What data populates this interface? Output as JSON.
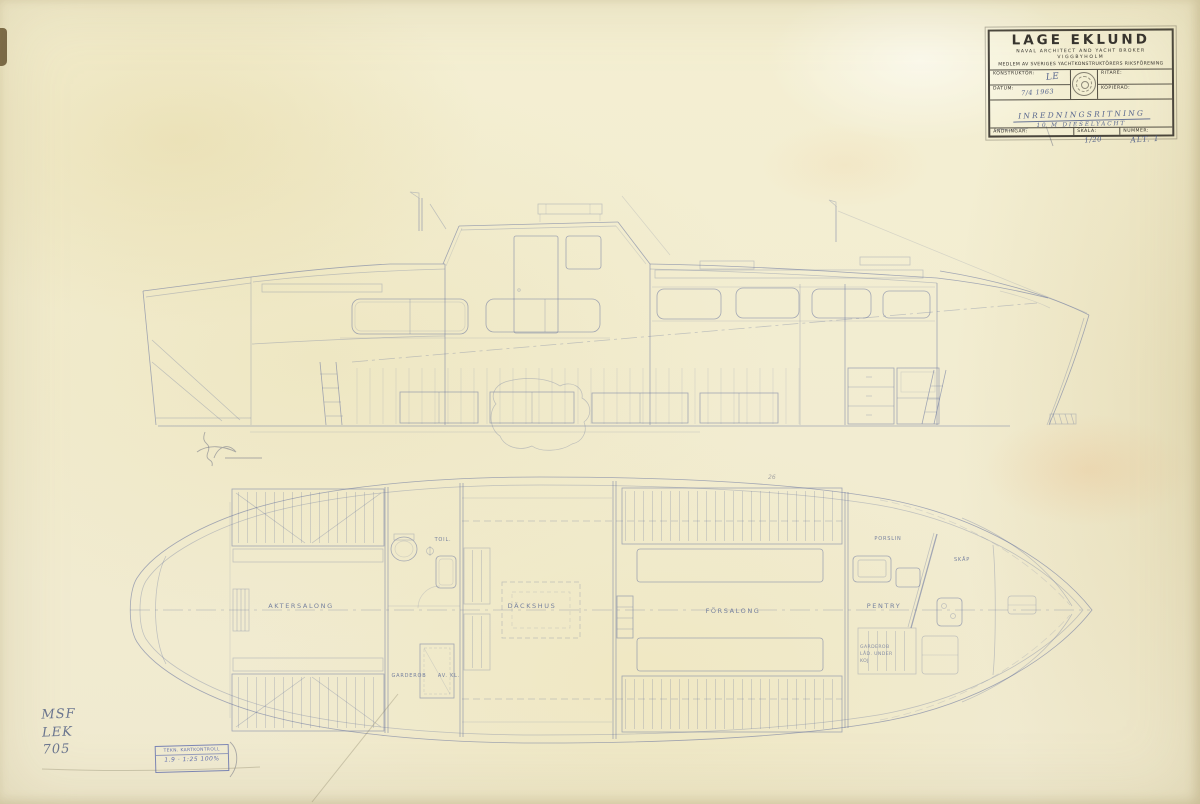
{
  "title_block": {
    "company": "LAGE EKLUND",
    "subtitle": "NAVAL ARCHITECT AND YACHT BROKER",
    "location": "VIGGBYHOLM",
    "membership": "MEDLEM AV SVERIGES YACHTKONSTRUKTÖRERS RIKSFÖRENING",
    "konstruktor_label": "KONSTRUKTÖR:",
    "konstruktor_value": "LE",
    "ritare_label": "RITARE:",
    "datum_label": "DATUM:",
    "datum_value": "7/4 1963",
    "kopierad_label": "KOPIERAD:",
    "title_line1": "INREDNINGSRITNING",
    "title_line2": "10 M DIESELYACHT",
    "andringar_label": "ÄNDRINGAR:",
    "skala_label": "SKALA:",
    "skala_value": "1/20",
    "nummer_label": "NUMMER:",
    "nummer_value": "ALT. 1"
  },
  "plan_labels": {
    "aktersalong": "AKTERSALONG",
    "dackshus": "DÄCKSHUS",
    "forsalong": "FÖRSALONG",
    "pentry": "PENTRY",
    "toil": "TOIL.",
    "garderob": "GARDEROB",
    "avkl": "AV. KL.",
    "porslin": "PORSLIN",
    "skap": "SKÅP",
    "note_line1": "GARDEROB",
    "note_line2": "LÅD. UNDER",
    "note_line3": "KOJ",
    "pencil_mark": "26"
  },
  "annotations": {
    "pencil_line1": "MSF",
    "pencil_line2": "LEK",
    "pencil_line3": "705"
  },
  "archive_stamp": {
    "line1": "TEKN. KARTKONTROLL",
    "line2": "1.9 · 1:25 100%"
  }
}
